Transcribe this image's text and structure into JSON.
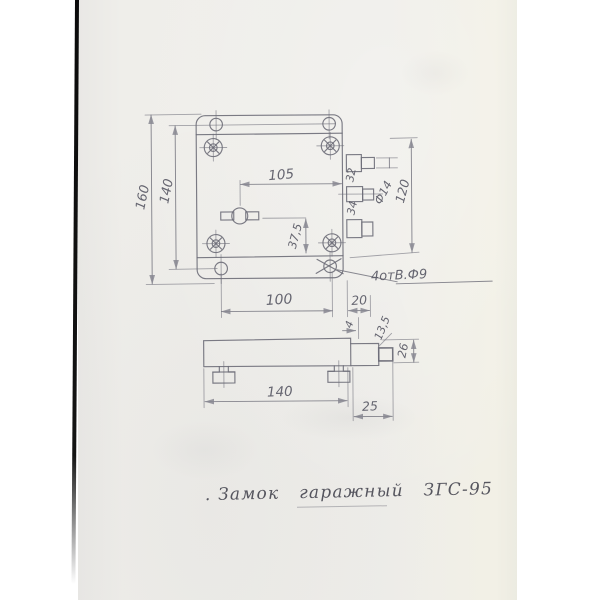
{
  "caption": {
    "text": ". Замок   гаражный   ЗГС-95"
  },
  "front_view": {
    "dims": {
      "overall_height": "160",
      "hole_row_spacing": "140",
      "keyhole_offset": "105",
      "keyhole_drop": "37,5",
      "hole_col_spacing": "100",
      "edge_to_latch": "20",
      "latch_pitch_upper": "32",
      "latch_pitch_lower": "34",
      "latch_diameter": "Ф14",
      "latch_span": "120",
      "holes_note": "4отВ.Ф9"
    }
  },
  "side_view": {
    "dims": {
      "step_offset": "4",
      "step_drop": "13,5",
      "end_height": "26",
      "body_length": "140",
      "latch_projection": "25"
    }
  },
  "colors": {
    "background": "#ffffff",
    "paper": "#eeede9",
    "ink": "#6d6d78",
    "ink_text": "#5a5a66",
    "caption_ink": "#41414c",
    "scan_edge": "#0b0b0b"
  }
}
